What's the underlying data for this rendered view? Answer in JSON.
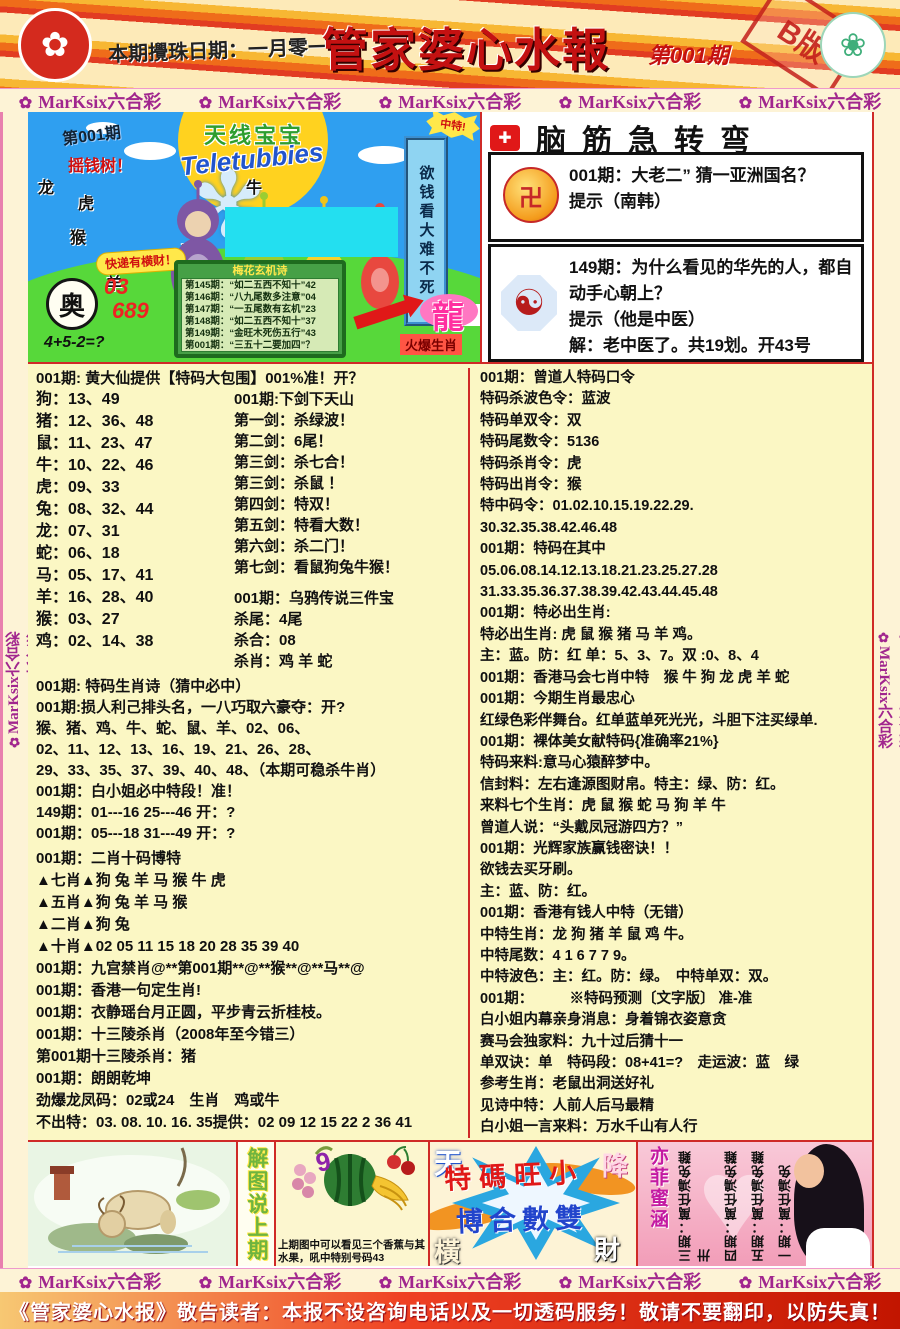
{
  "header": {
    "date_note": "本期攪珠日期：一月零一日",
    "title": "管家婆心水報",
    "issue": "第001期",
    "stamp": "B版",
    "hk_emblem_glyph": "✿",
    "macau_emblem_glyph": "❀"
  },
  "band": {
    "items": [
      {
        "flower": "✿",
        "label": "MarKsix六合彩"
      },
      {
        "flower": "✿",
        "label": "MarKsix六合彩"
      },
      {
        "flower": "✿",
        "label": "MarKsix六合彩"
      },
      {
        "flower": "✿",
        "label": "MarKsix六合彩"
      },
      {
        "flower": "✿",
        "label": "MarKsix六合彩"
      }
    ]
  },
  "rail": {
    "items": [
      {
        "flower": "✿",
        "label": "MarKsix六合彩"
      },
      {
        "flower": "✿",
        "label": "MarKsix六合彩"
      },
      {
        "flower": "✿",
        "label": "MarKsix六合彩"
      },
      {
        "flower": "✿",
        "label": "MarKsix六合彩"
      },
      {
        "flower": "✿",
        "label": "MarKsix六合彩"
      },
      {
        "flower": "✿",
        "label": "MarKsix六合彩"
      },
      {
        "flower": "✿",
        "label": "MarKsix六合彩"
      }
    ]
  },
  "promo": {
    "issue": "第001期",
    "money_tree": "摇钱树！",
    "zodiac_scatter": [
      "龙",
      "虎",
      "牛",
      "猴",
      "马",
      "羊",
      "鼠"
    ],
    "show_title_cn": "天线宝宝",
    "show_title_en": "Teletubbies",
    "win_burst": "中特!",
    "side_banner": "欲钱看大难不死",
    "pill": "快递有横财！",
    "ao_char": "奥",
    "code1": "03",
    "code2": "689",
    "formula": "4+5-2=?",
    "board_title": "梅花玄机诗",
    "board_lines": [
      "第145期：“如二五西不知十”42",
      "第146期：“八九尾数多注意”04",
      "第147期：“一五尾数有玄机”23",
      "第148期：“如二五西不知十”37",
      "第149期：“金旺木死伤五行”43",
      "第001期：“三五十二要加四”？"
    ],
    "dragon": "龍",
    "dragon_sub": "火爆生肖"
  },
  "teaser": {
    "title": "脑筋急转弯",
    "logo_glyph": "✚",
    "items": [
      {
        "icon": "卍",
        "q": "001期：大老二” 猜一亚洲国名？",
        "hint": "提示（南韩）",
        "answer": ""
      },
      {
        "icon": "☯",
        "q": "149期：为什么看见的华先的人，都自动手心朝上？",
        "hint": "提示（他是中医）",
        "answer": "解：老中医了。共19划。开43号"
      }
    ]
  },
  "left_col": {
    "s1_header": "001期: 黄大仙提供【特码大包围】001%准！开？",
    "zodiac_rows": [
      "狗：13、49",
      "猪：12、36、48",
      "鼠：11、23、47",
      "牛：10、22、46",
      "虎：09、33",
      "兔：08、32、44",
      "龙：07、31",
      "蛇：06、18",
      "马：05、17、41",
      "羊：16、28、40",
      "猴：03、27",
      "鸡：02、14、38"
    ],
    "sword_lines": [
      "001期:下剑下天山",
      "第一剑：杀绿波！",
      "第二剑：6尾！",
      "第三剑：杀七合！",
      "第三剑：杀鼠 ！",
      "第四剑：特双！",
      "第五剑：特看大数！",
      "第六剑：杀二门！",
      "第七剑：看鼠狗兔牛猴！"
    ],
    "crow_lines": [
      "001期：乌鸦传说三件宝",
      "杀尾：4尾",
      "杀合：08",
      "杀肖：鸡 羊 蛇"
    ],
    "s2_lines": [
      "001期: 特码生肖诗（猜中必中）",
      "001期:损人利己排头名，一八巧取六豪夺：开?",
      "猴、猪、鸡、牛、蛇、鼠、羊、02、06、",
      "02、11、12、13、16、19、21、26、28、",
      "29、33、35、37、39、40、48、（本期可稳杀牛肖）",
      "001期：白小姐必中特段！准！",
      "149期：01---16  25---46  开：?",
      "001期：05---18  31---49  开：?"
    ],
    "s3_lines": [
      "001期：二肖十码博特",
      "▲七肖▲狗 兔 羊 马 猴 牛 虎",
      "▲五肖▲狗 兔 羊 马 猴",
      "▲二肖▲狗 兔",
      "▲十肖▲02 05 11 15 18 20 28 35 39 40",
      "001期：九宫禁肖@**第001期**@**猴**@**马**@",
      "001期：香港一句定生肖!",
      "001期：衣静瑶台月正圆，平步青云折桂枝。",
      "001期：十三陵杀肖（2008年至今错三）",
      "第001期十三陵杀肖：猪",
      "001期：朗朗乾坤",
      "劲爆龙凤码：02或24　生肖　鸡或牛",
      "不出特：03. 08. 10. 16. 35提供：02 09 12 15 22 2 36 41"
    ]
  },
  "right_col": {
    "lines": [
      "001期：曾道人特码口令",
      "特码杀波色令：蓝波",
      "特码单双令：双",
      "特码尾数令：5136",
      "特码杀肖令：虎",
      "特码出肖令：猴",
      "特中码令：01.02.10.15.19.22.29.",
      "30.32.35.38.42.46.48",
      "001期：特码在其中",
      "05.06.08.14.12.13.18.21.23.25.27.28",
      "31.33.35.36.37.38.39.42.43.44.45.48",
      "001期：特必出生肖:",
      "特必出生肖: 虎 鼠 猴 猪 马 羊 鸡。",
      "主：蓝。防：红 单：5、3、7。双 :0、8、4",
      "001期：香港马会七肖中特　猴 牛 狗 龙 虎 羊 蛇",
      "001期：今期生肖最忠心",
      "红绿色彩伴舞台。红单蓝单死光光，斗胆下注买绿单.",
      "001期：裸体美女献特码{准确率21%}",
      "特码来料:意马心猿醉梦中。",
      "信封料：左右逢源图财帛。特主：绿、防：红。",
      "来料七个生肖：虎 鼠 猴 蛇 马 狗 羊 牛",
      "曾道人说：“头戴凤冠游四方？”",
      "001期：光辉家族赢钱密诀！！",
      "欲钱去买牙刷。",
      "主：蓝、防：红。",
      "001期：香港有钱人中特（无错）",
      "中特生肖：龙 狗 猪 羊 鼠 鸡 牛。",
      "中特尾数：4 1 6 7 7 9。",
      "中特波色：主：红。防：绿。　中特单双：双。",
      "001期：　　　※特码预测〔文字版〕 准-准",
      "白小姐内幕亲身消息：身着锦衣姿意贪",
      "赛马会独家料：九十过后猜十一",
      "单双诀：单　特码段：08+41=?　走运波：蓝　绿",
      "参考生肖：老鼠出洞送好礼",
      "见诗中特：人前人后马最精",
      "白小姐一言来料：万水千山有人行"
    ]
  },
  "bottom": {
    "explain_label": "解图说上期",
    "fruit_caption1": "上期图中可以看见三个香蕉与其",
    "fruit_caption2": "水果，吼中特别号码43",
    "slogan_top": "特碼旺小",
    "slogan_bottom": "博合數雙",
    "corner_chars": [
      "天",
      "降",
      "橫",
      "財"
    ],
    "yifei": "亦菲蜜涵",
    "flipped_cols": [
      "三期：萬任鴻免難卅",
      "四期：萬任鴻免難",
      "五期：萬任鴻免難",
      "一期：萬任鴻免"
    ]
  },
  "footer": {
    "notice": "《管家婆心水报》敬告读者：本报不设咨询电话以及一切透码服务！敬请不要翻印，以防失真！"
  }
}
